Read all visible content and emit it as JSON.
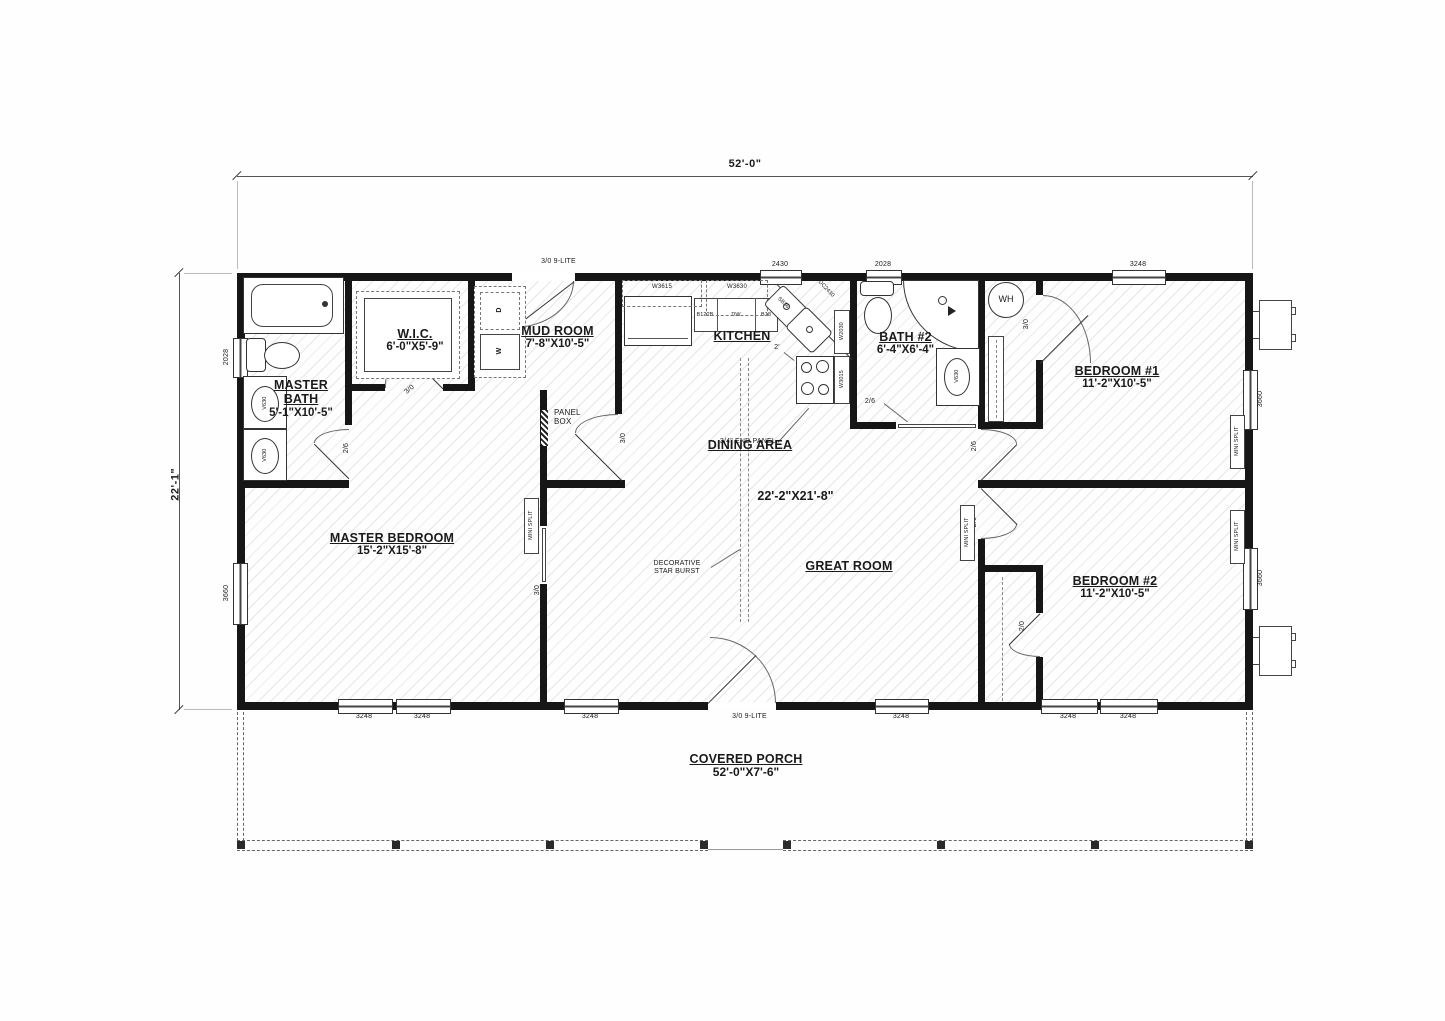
{
  "dimensions": {
    "overall_width": "52'-0\"",
    "overall_depth": "22'-1\""
  },
  "rooms": {
    "master_bath": {
      "name": "MASTER BATH",
      "size": "5'-1\"X10'-5\""
    },
    "wic": {
      "name": "W.I.C.",
      "size": "6'-0\"X5'-9\""
    },
    "mud_room": {
      "name": "MUD ROOM",
      "size": "7'-8\"X10'-5\""
    },
    "kitchen": {
      "name": "KITCHEN"
    },
    "bath2": {
      "name": "BATH #2",
      "size": "6'-4\"X6'-4\""
    },
    "bedroom1": {
      "name": "BEDROOM #1",
      "size": "11'-2\"X10'-5\""
    },
    "dining": {
      "name": "DINING AREA",
      "size": "22'-2\"X21'-8\""
    },
    "great_room": {
      "name": "GREAT ROOM"
    },
    "master_bedroom": {
      "name": "MASTER BEDROOM",
      "size": "15'-2\"X15'-8\""
    },
    "bedroom2": {
      "name": "BEDROOM #2",
      "size": "11'-2\"X10'-5\""
    },
    "porch": {
      "name": "COVERED PORCH",
      "size": "52'-0\"X7'-6\""
    }
  },
  "windows": {
    "w2430": "2430",
    "w2028": "2028",
    "w3248": "3248",
    "w3660": "3660"
  },
  "doors": {
    "entry": "3/0 9-LITE",
    "d30": "3/0",
    "d26": "2/6",
    "d20": "2/0"
  },
  "kitchen": {
    "w3615": "W3615",
    "w3630": "W3630",
    "b122b": "B122B",
    "dw": "DW",
    "b18": "B18",
    "sb36": "SB36",
    "dc2430": "DC2430",
    "w2030": "W2030",
    "w3015": "W3015",
    "counter_note": "2'",
    "end_panel_note": "3/4\" END PANEL"
  },
  "laundry": {
    "washer": "W",
    "dryer": "D"
  },
  "equipment": {
    "water_heater": "WH",
    "mini_split": "MINI SPLIT",
    "panel_box": "PANEL BOX"
  },
  "fixtures": {
    "vanity": "V630"
  },
  "notes": {
    "star_burst": "DECORATIVE STAR BURST"
  }
}
